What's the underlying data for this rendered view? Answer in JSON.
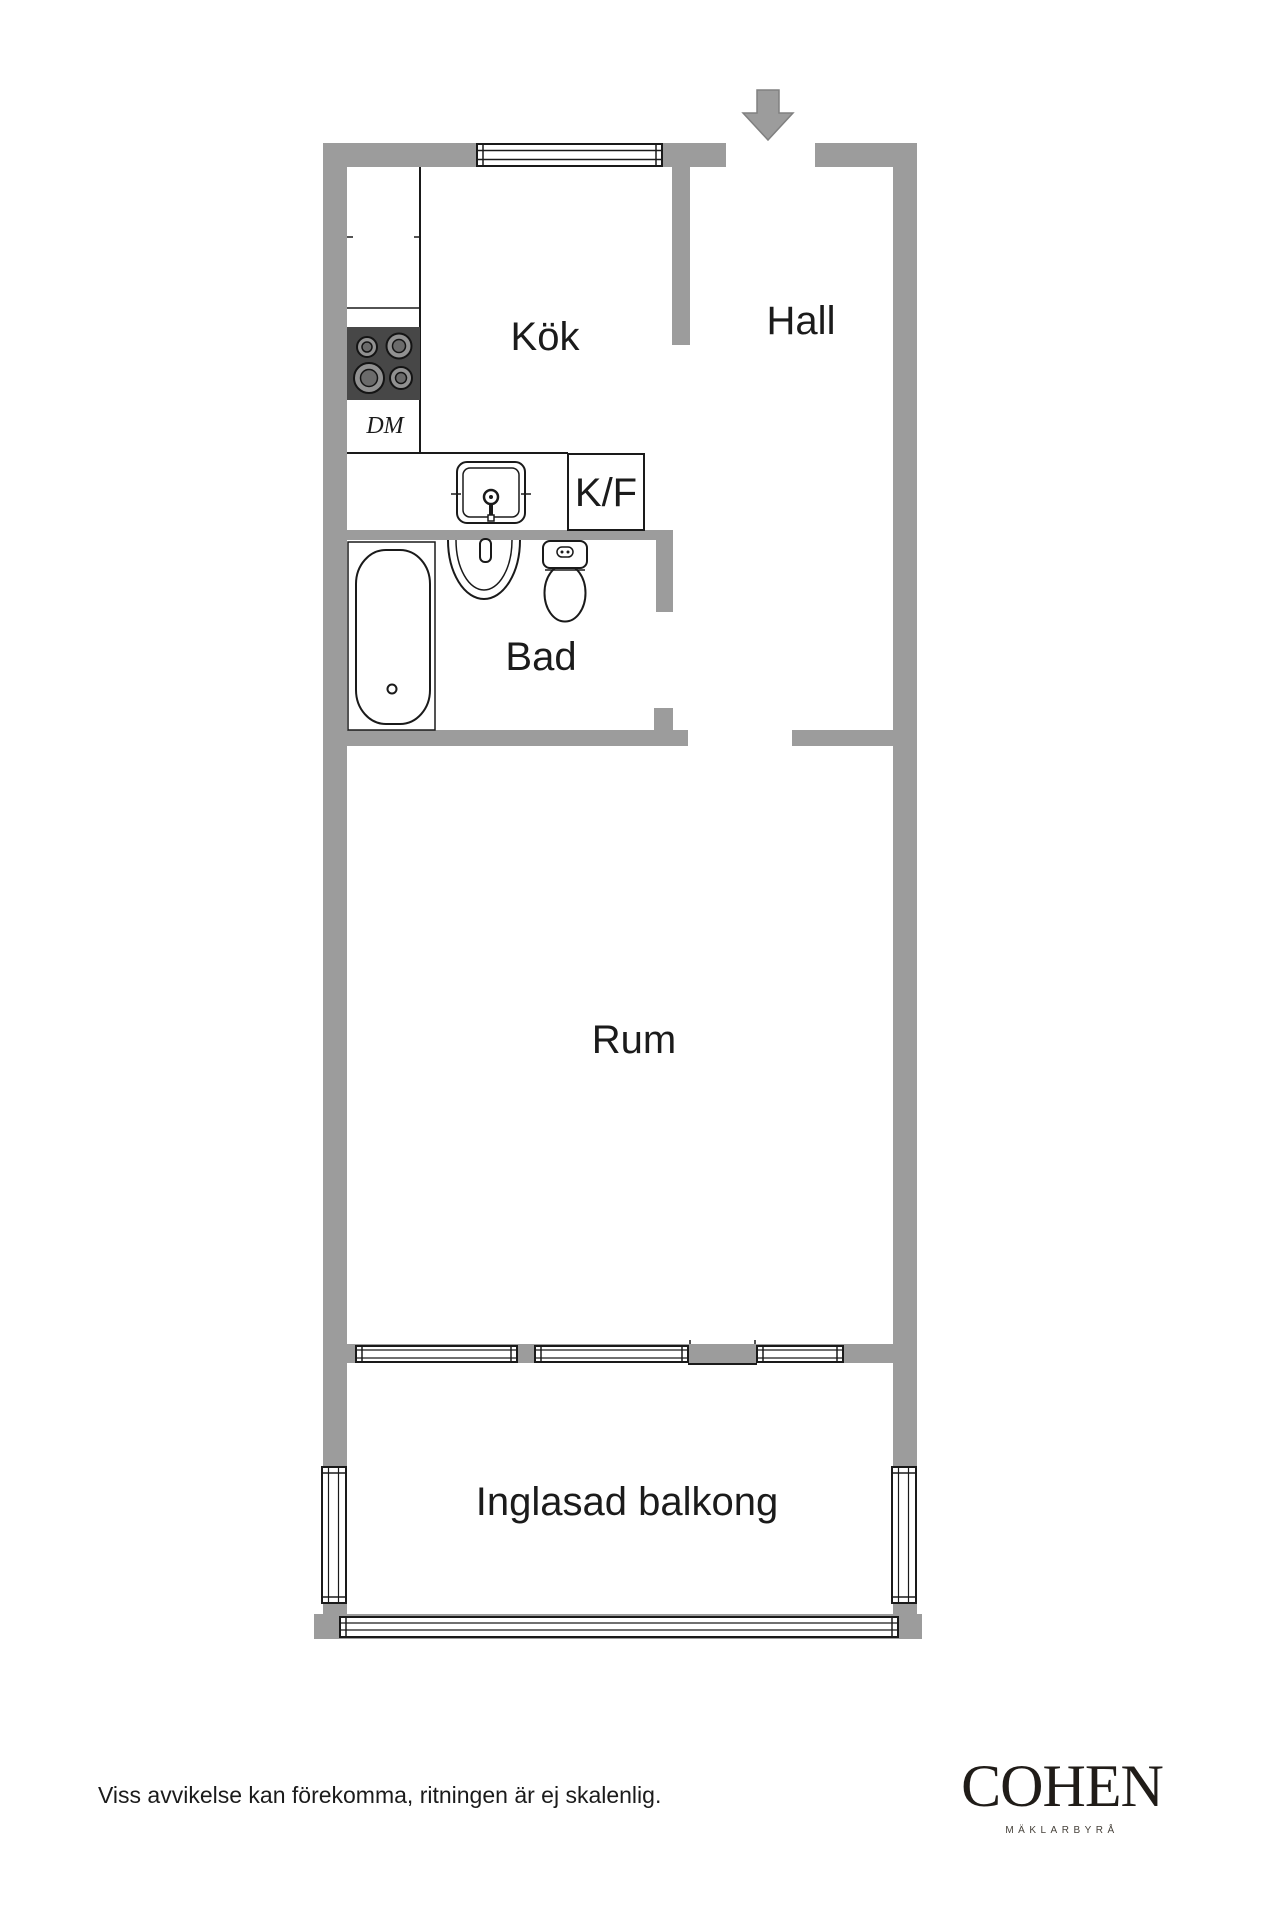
{
  "floorplan": {
    "entrance": {
      "arrow_direction": "down"
    },
    "rooms": [
      {
        "id": "kitchen",
        "label": "Kök"
      },
      {
        "id": "hall",
        "label": "Hall"
      },
      {
        "id": "bathroom",
        "label": "Bad"
      },
      {
        "id": "room",
        "label": "Rum"
      },
      {
        "id": "balcony",
        "label": "Inglasad balkong"
      }
    ],
    "appliances": [
      {
        "id": "dishwasher",
        "label": "DM"
      },
      {
        "id": "fridge-freezer",
        "label": "K/F"
      }
    ],
    "colors": {
      "wall": "#9c9c9c",
      "line": "#1a1a1a",
      "stove": "#474747",
      "text": "#1b1b1b"
    }
  },
  "footer": {
    "disclaimer": "Viss avvikelse kan förekomma, ritningen är ej skalenlig.",
    "brand": {
      "name": "COHEN",
      "tagline": "MÄKLARBYRÅ"
    }
  }
}
